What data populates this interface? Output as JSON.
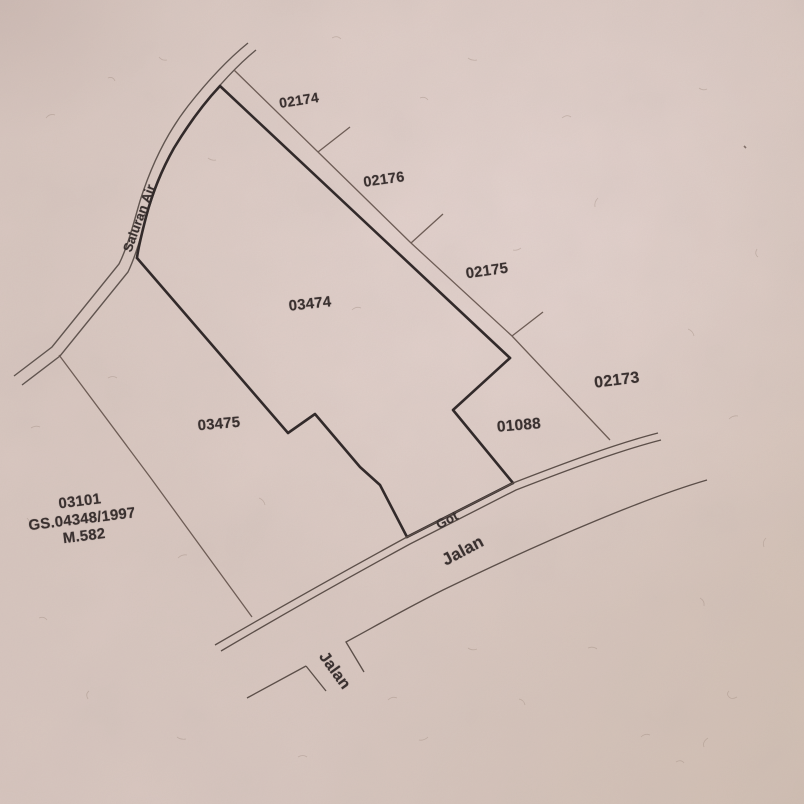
{
  "map": {
    "water_channel_label": "Saluran Air",
    "gutter_label": "Got",
    "main_road_label": "Jalan",
    "branch_road_label": "Jalan",
    "parcels": [
      {
        "id": "02174"
      },
      {
        "id": "02176"
      },
      {
        "id": "02175"
      },
      {
        "id": "02173"
      },
      {
        "id": "03474"
      },
      {
        "id": "03475"
      },
      {
        "id": "01088"
      }
    ],
    "reference_parcel": {
      "id": "03101",
      "certificate_number": "GS.04348/1997",
      "area_code": "M.582"
    }
  },
  "colors": {
    "paper": "#d8c6bf",
    "paper_highlight": "#eeddd9",
    "paper_shadow": "#c9b7b0",
    "boundary_ink": "#332b2b",
    "thin_line_ink": "#6e5d56",
    "label_ink": "#3a3130"
  }
}
